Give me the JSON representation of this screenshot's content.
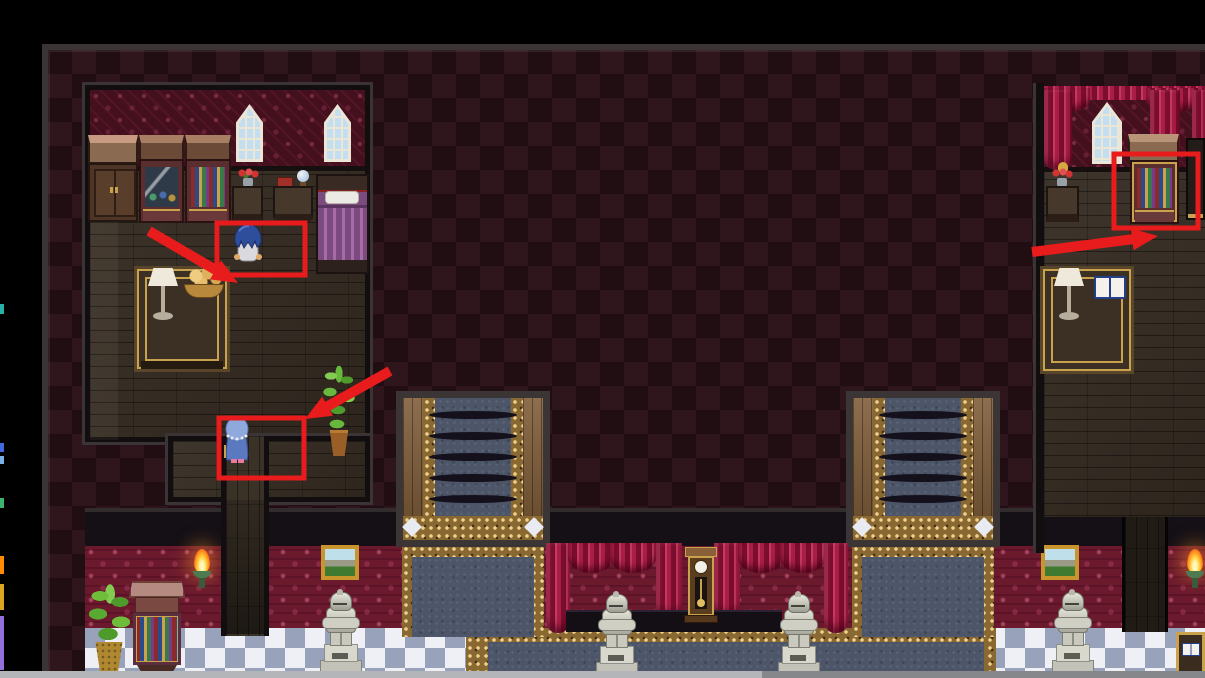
{
  "meta": {
    "screen_width": 1205,
    "screen_height": 678,
    "content": "rpg-game-interior-screenshot-with-annotations"
  },
  "palette": {
    "annotation_red": "#e81c1c",
    "diamond_dark": "#200e13",
    "diamond_light": "#2f151c",
    "room_wall_red": "#44101e",
    "wall_red": "#6b1a2e",
    "wood_floor": "#342b21",
    "checker_white": "#eef0f5",
    "checker_blue": "#98a2ba",
    "carpet_blue": "#4d5669",
    "gold": "#c9a24e",
    "curtain_crimson": "#a81e46",
    "stair_wood": "#7d5a35",
    "statue_silver": "#d6d6cc",
    "chrome_bar_left": "#b3b5b9",
    "chrome_bar_right": "#85878b"
  },
  "chrome": {
    "top_bar": {
      "x": 0,
      "y": 0,
      "w": 1205,
      "h": 44,
      "color": "#000000"
    },
    "left_bar": {
      "x": 0,
      "y": 44,
      "w": 42,
      "h": 634,
      "color": "#000000"
    },
    "bottom_bar": {
      "y": 671,
      "h": 7,
      "split_x": 762
    },
    "dock_strip": [
      {
        "y": 304,
        "h": 10,
        "color": "#27b0a6"
      },
      {
        "y": 443,
        "h": 9,
        "color": "#4169e1"
      },
      {
        "y": 456,
        "h": 8,
        "color": "#7ab2e8"
      },
      {
        "y": 498,
        "h": 10,
        "color": "#3cb371"
      },
      {
        "y": 556,
        "h": 18,
        "color": "#ff8c00"
      },
      {
        "y": 584,
        "h": 26,
        "color": "#daa520"
      },
      {
        "y": 616,
        "h": 54,
        "color": "#9370db"
      }
    ]
  },
  "annotations": {
    "color": "#e81c1c",
    "boxes": [
      {
        "id": "npc-bluehair-highlight",
        "x": 217,
        "y": 223,
        "w": 88,
        "h": 52
      },
      {
        "id": "npc-granny-highlight",
        "x": 219,
        "y": 418,
        "w": 85,
        "h": 60
      },
      {
        "id": "bookshelf-highlight",
        "x": 1114,
        "y": 154,
        "w": 84,
        "h": 74
      }
    ],
    "arrows": [
      {
        "id": "arrow-npc-bluehair",
        "x1": 149,
        "y1": 231,
        "x2": 238,
        "y2": 283
      },
      {
        "id": "arrow-npc-granny",
        "x1": 390,
        "y1": 371,
        "x2": 305,
        "y2": 419
      },
      {
        "id": "arrow-bookshelf",
        "x1": 1032,
        "y1": 252,
        "x2": 1158,
        "y2": 236
      }
    ]
  },
  "scene": {
    "rooms": [
      "upper-left-bedroom",
      "upper-right-study",
      "grand-hall-with-twin-staircases"
    ],
    "npcs": [
      {
        "id": "npc-bluehair",
        "desc": "blue-haired character facing away",
        "x": 231,
        "y": 221
      },
      {
        "id": "npc-granny",
        "desc": "hooded character in blue robe",
        "x": 220,
        "y": 415
      }
    ],
    "highlighted_objects": [
      "npc-bluehair",
      "npc-granny",
      "study-bookshelf"
    ],
    "stairwells": [
      {
        "x": 396
      },
      {
        "x": 846
      }
    ],
    "statues": [
      {
        "x": 318,
        "y": 581
      },
      {
        "x": 594,
        "y": 585
      },
      {
        "x": 776,
        "y": 585
      },
      {
        "x": 1050,
        "y": 581
      }
    ]
  }
}
